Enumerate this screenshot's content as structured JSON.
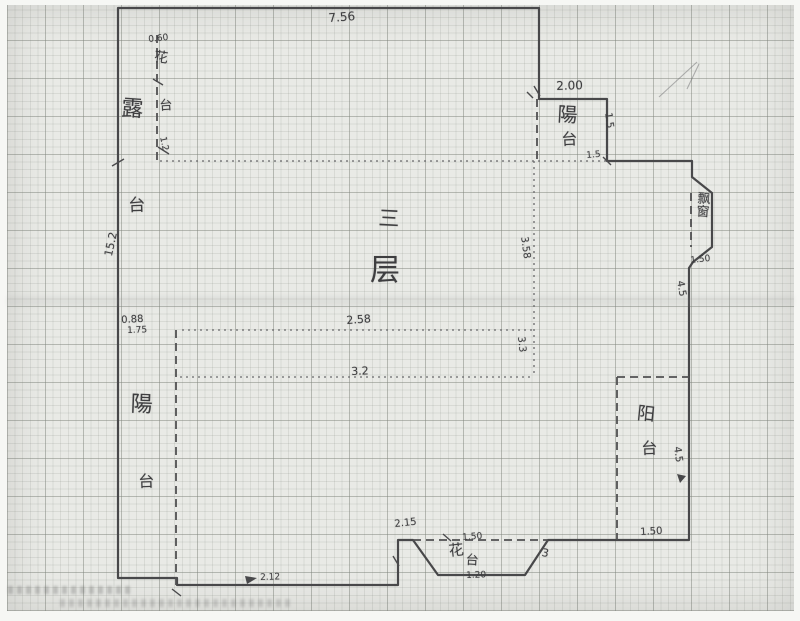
{
  "title": "Hand-drawn third-floor plan sketch on graph paper",
  "floor": {
    "char1": "三",
    "char2": "层"
  },
  "rooms": {
    "terrace": {
      "char1": "露",
      "char2": "台"
    },
    "planter_left": {
      "char1": "花",
      "char2": "台"
    },
    "balcony_top_right": {
      "char1": "陽",
      "char2": "台"
    },
    "balcony_bottom_left": {
      "char1": "陽",
      "char2": "台"
    },
    "balcony_bottom_right": {
      "char1": "阳",
      "char2": "台"
    },
    "flower_bed_bottom": {
      "char1": "花",
      "char2": "台"
    },
    "bay_window": "飘窗"
  },
  "dims": {
    "top_width": "7.56",
    "planter_width": "0.60",
    "planter_length": "1.2",
    "left_height": "15.2",
    "left_a": "0.88",
    "left_b": "1.75",
    "balcony_tr_width": "2.00",
    "balcony_tr_depth": "1.5",
    "balcony_tr_corner": "1.5",
    "bay_window": "1.50",
    "right_upper": "4.5",
    "interior_h1": "2.58",
    "interior_h2": "3.2",
    "interior_v1": "3.58",
    "interior_v2": "3.3",
    "right_lower": "4.5",
    "balcony_br": "1.50",
    "flowerbed_top": "1.50",
    "flowerbed_right": "3",
    "flowerbed_bottom": "1.20",
    "step": "2.15",
    "bottom_wall": "2.12"
  },
  "colors": {
    "paper": "#e9eae6",
    "grid_minor": "#c9ccc6",
    "grid_major": "#aeb2ab",
    "ink": "#48484a"
  }
}
